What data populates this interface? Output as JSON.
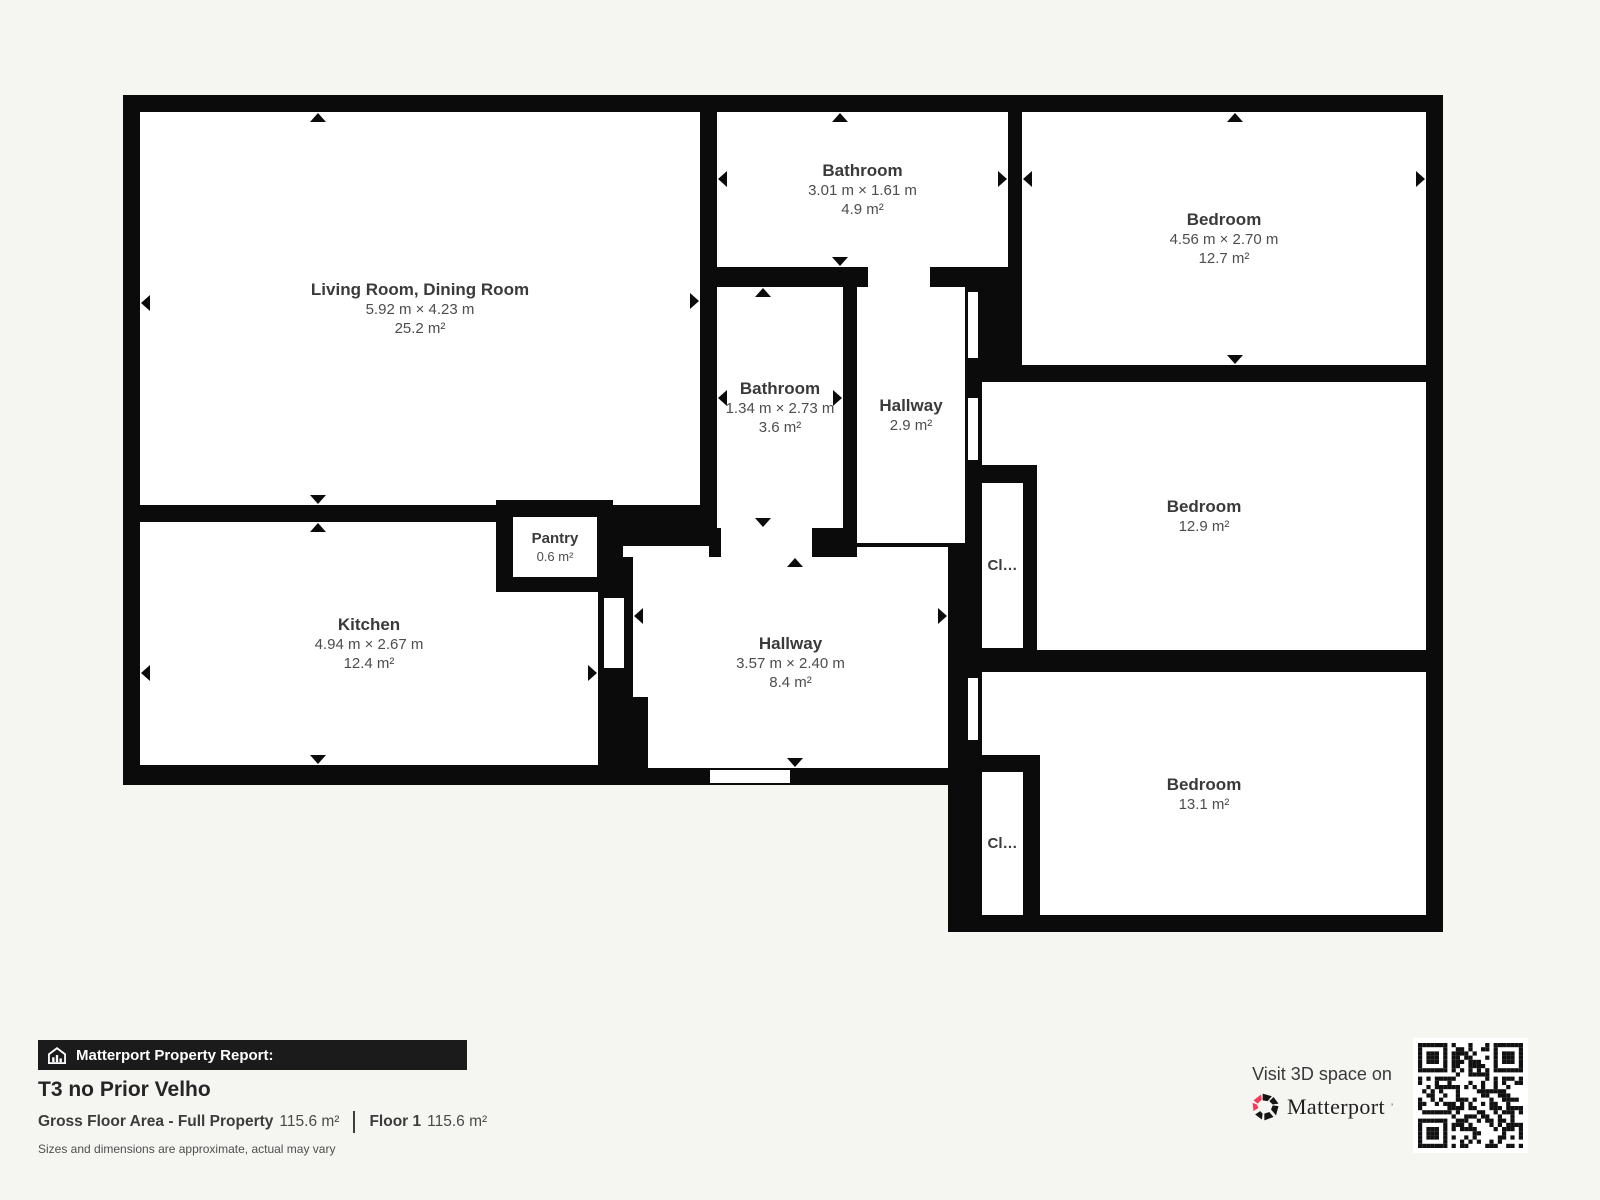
{
  "plan": {
    "rooms": [
      {
        "name": "Living Room, Dining Room",
        "dims": "5.92 m × 4.23 m",
        "area": "25.2 m²"
      },
      {
        "name": "Kitchen",
        "dims": "4.94 m × 2.67 m",
        "area": "12.4 m²"
      },
      {
        "name": "Pantry",
        "area": "0.6 m²"
      },
      {
        "name": "Bathroom",
        "dims": "3.01 m × 1.61 m",
        "area": "4.9 m²"
      },
      {
        "name": "Bathroom",
        "dims": "1.34 m × 2.73 m",
        "area": "3.6 m²"
      },
      {
        "name": "Hallway",
        "area": "2.9 m²"
      },
      {
        "name": "Hallway",
        "dims": "3.57 m × 2.40 m",
        "area": "8.4 m²"
      },
      {
        "name": "Bedroom",
        "dims": "4.56 m × 2.70 m",
        "area": "12.7 m²"
      },
      {
        "name": "Bedroom",
        "area": "12.9 m²"
      },
      {
        "name": "Bedroom",
        "area": "13.1 m²"
      },
      {
        "name": "Cl…"
      },
      {
        "name": "Cl…"
      }
    ]
  },
  "footer": {
    "report_label": "Matterport Property Report:",
    "property_title": "T3 no Prior Velho",
    "gfa_label": "Gross Floor Area - Full Property",
    "gfa_value": "115.6 m²",
    "floor_label": "Floor 1",
    "floor_value": "115.6 m²",
    "disclaimer": "Sizes and dimensions are approximate, actual may vary"
  },
  "promo": {
    "visit_text": "Visit 3D space on",
    "brand": "Matterport",
    "brand_mark": "’",
    "brand_pink": "#f43b5c"
  },
  "icons": {
    "banner_icon": "house-report-icon",
    "qr_icon": "qr-code"
  }
}
